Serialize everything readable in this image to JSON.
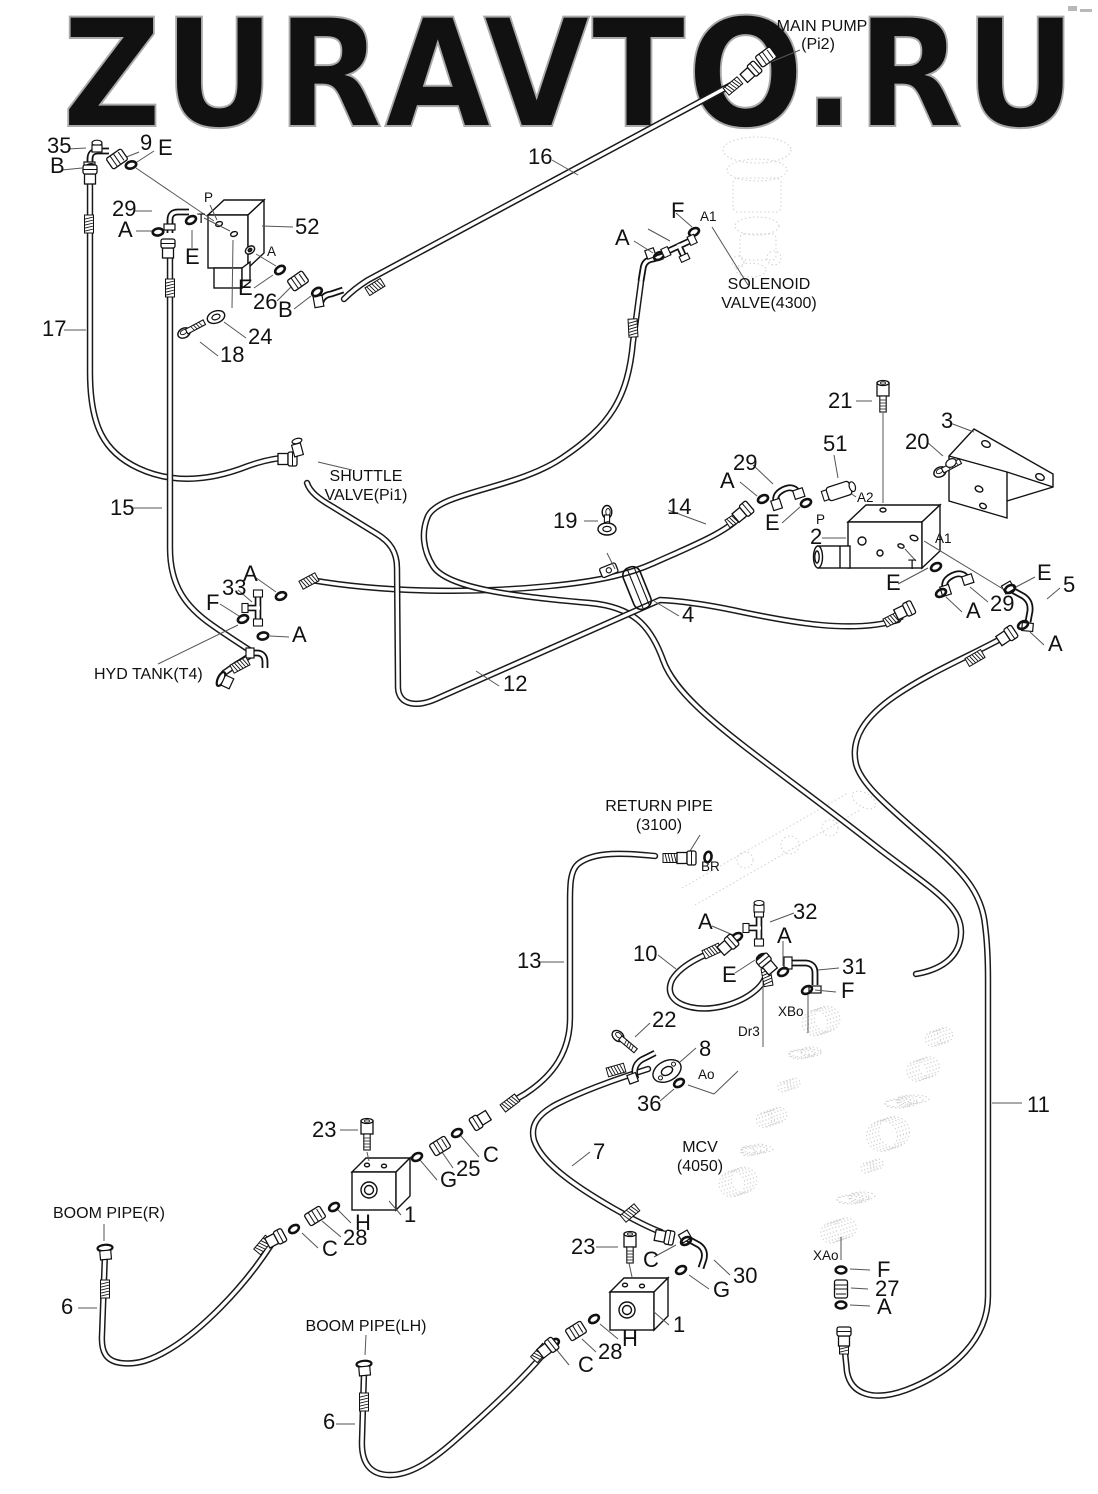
{
  "watermark": {
    "text": "ZURAVTO.RU",
    "color": "#a9a9a9"
  },
  "colors": {
    "line": "#1a1a1a",
    "leader": "#555555",
    "ghost": "#c4c4c4",
    "label": "#111111"
  },
  "labels": {
    "component_names": [
      {
        "t": "MAIN PUMP",
        "x": 822,
        "y": 31,
        "a": "middle"
      },
      {
        "t": "(Pi2)",
        "x": 818,
        "y": 49,
        "a": "middle"
      },
      {
        "t": "SOLENOID",
        "x": 769,
        "y": 289,
        "a": "middle"
      },
      {
        "t": "VALVE(4300)",
        "x": 769,
        "y": 308,
        "a": "middle"
      },
      {
        "t": "SHUTTLE",
        "x": 366,
        "y": 481,
        "a": "middle"
      },
      {
        "t": "VALVE(Pi1)",
        "x": 366,
        "y": 500,
        "a": "middle"
      },
      {
        "t": "HYD TANK(T4)",
        "x": 94,
        "y": 679,
        "a": "start"
      },
      {
        "t": "RETURN PIPE",
        "x": 659,
        "y": 811,
        "a": "middle"
      },
      {
        "t": "(3100)",
        "x": 659,
        "y": 830,
        "a": "middle"
      },
      {
        "t": "MCV",
        "x": 700,
        "y": 1152,
        "a": "middle"
      },
      {
        "t": "(4050)",
        "x": 700,
        "y": 1171,
        "a": "middle"
      },
      {
        "t": "BOOM PIPE(R)",
        "x": 53,
        "y": 1218,
        "a": "start"
      },
      {
        "t": "BOOM PIPE(LH)",
        "x": 366,
        "y": 1331,
        "a": "middle"
      }
    ],
    "part_numbers": [
      {
        "t": "35",
        "x": 47,
        "y": 153
      },
      {
        "t": "9",
        "x": 140,
        "y": 150
      },
      {
        "t": "17",
        "x": 42,
        "y": 336
      },
      {
        "t": "16",
        "x": 528,
        "y": 164
      },
      {
        "t": "52",
        "x": 295,
        "y": 234
      },
      {
        "t": "26",
        "x": 253,
        "y": 309
      },
      {
        "t": "24",
        "x": 248,
        "y": 344
      },
      {
        "t": "18",
        "x": 220,
        "y": 362
      },
      {
        "t": "29",
        "x": 112,
        "y": 216
      },
      {
        "t": "21",
        "x": 828,
        "y": 408
      },
      {
        "t": "3",
        "x": 941,
        "y": 428
      },
      {
        "t": "20",
        "x": 905,
        "y": 449
      },
      {
        "t": "51",
        "x": 823,
        "y": 451
      },
      {
        "t": "2",
        "x": 810,
        "y": 544
      },
      {
        "t": "5",
        "x": 1063,
        "y": 592
      },
      {
        "t": "29",
        "x": 733,
        "y": 470
      },
      {
        "t": "29",
        "x": 990,
        "y": 611
      },
      {
        "t": "15",
        "x": 110,
        "y": 515
      },
      {
        "t": "19",
        "x": 553,
        "y": 528
      },
      {
        "t": "14",
        "x": 667,
        "y": 514
      },
      {
        "t": "33",
        "x": 222,
        "y": 595
      },
      {
        "t": "12",
        "x": 503,
        "y": 691
      },
      {
        "t": "4",
        "x": 682,
        "y": 622
      },
      {
        "t": "32",
        "x": 793,
        "y": 919
      },
      {
        "t": "10",
        "x": 633,
        "y": 961
      },
      {
        "t": "31",
        "x": 842,
        "y": 974
      },
      {
        "t": "22",
        "x": 652,
        "y": 1027
      },
      {
        "t": "8",
        "x": 699,
        "y": 1056
      },
      {
        "t": "36",
        "x": 637,
        "y": 1111
      },
      {
        "t": "13",
        "x": 517,
        "y": 968
      },
      {
        "t": "7",
        "x": 593,
        "y": 1159
      },
      {
        "t": "23",
        "x": 312,
        "y": 1137
      },
      {
        "t": "25",
        "x": 456,
        "y": 1176
      },
      {
        "t": "28",
        "x": 343,
        "y": 1245
      },
      {
        "t": "23",
        "x": 571,
        "y": 1254
      },
      {
        "t": "30",
        "x": 733,
        "y": 1283
      },
      {
        "t": "28",
        "x": 598,
        "y": 1359
      },
      {
        "t": "27",
        "x": 875,
        "y": 1296
      },
      {
        "t": "11",
        "x": 1027,
        "y": 1112
      },
      {
        "t": "6",
        "x": 61,
        "y": 1314
      },
      {
        "t": "6",
        "x": 323,
        "y": 1429
      },
      {
        "t": "1",
        "x": 404,
        "y": 1222
      },
      {
        "t": "1",
        "x": 673,
        "y": 1332
      }
    ],
    "fitting_letters": [
      {
        "t": "E",
        "x": 158,
        "y": 155
      },
      {
        "t": "B",
        "x": 50,
        "y": 173
      },
      {
        "t": "A",
        "x": 118,
        "y": 237
      },
      {
        "t": "E",
        "x": 185,
        "y": 264
      },
      {
        "t": "E",
        "x": 238,
        "y": 295
      },
      {
        "t": "B",
        "x": 278,
        "y": 317
      },
      {
        "t": "F",
        "x": 671,
        "y": 218
      },
      {
        "t": "A",
        "x": 615,
        "y": 245
      },
      {
        "t": "A",
        "x": 720,
        "y": 488
      },
      {
        "t": "E",
        "x": 765,
        "y": 530
      },
      {
        "t": "E",
        "x": 886,
        "y": 590
      },
      {
        "t": "A",
        "x": 966,
        "y": 618
      },
      {
        "t": "E",
        "x": 1037,
        "y": 580
      },
      {
        "t": "A",
        "x": 1048,
        "y": 651
      },
      {
        "t": "A",
        "x": 243,
        "y": 581
      },
      {
        "t": "F",
        "x": 206,
        "y": 610
      },
      {
        "t": "A",
        "x": 292,
        "y": 642
      },
      {
        "t": "A",
        "x": 698,
        "y": 929
      },
      {
        "t": "A",
        "x": 777,
        "y": 943
      },
      {
        "t": "E",
        "x": 722,
        "y": 982
      },
      {
        "t": "F",
        "x": 841,
        "y": 998
      },
      {
        "t": "C",
        "x": 483,
        "y": 1162
      },
      {
        "t": "G",
        "x": 440,
        "y": 1187
      },
      {
        "t": "H",
        "x": 355,
        "y": 1230
      },
      {
        "t": "C",
        "x": 322,
        "y": 1256
      },
      {
        "t": "C",
        "x": 643,
        "y": 1267
      },
      {
        "t": "G",
        "x": 713,
        "y": 1297
      },
      {
        "t": "H",
        "x": 622,
        "y": 1346
      },
      {
        "t": "C",
        "x": 578,
        "y": 1372
      },
      {
        "t": "F",
        "x": 877,
        "y": 1277
      },
      {
        "t": "A",
        "x": 877,
        "y": 1314
      }
    ],
    "port_labels": [
      {
        "t": "P",
        "x": 204,
        "y": 202
      },
      {
        "t": "T",
        "x": 197,
        "y": 223
      },
      {
        "t": "A",
        "x": 267,
        "y": 256
      },
      {
        "t": "A1",
        "x": 700,
        "y": 221
      },
      {
        "t": "A2",
        "x": 857,
        "y": 502
      },
      {
        "t": "P",
        "x": 816,
        "y": 524
      },
      {
        "t": "A1",
        "x": 935,
        "y": 543
      },
      {
        "t": "T",
        "x": 908,
        "y": 569
      },
      {
        "t": "BR",
        "x": 701,
        "y": 871
      },
      {
        "t": "XBo",
        "x": 778,
        "y": 1016
      },
      {
        "t": "Dr3",
        "x": 738,
        "y": 1036
      },
      {
        "t": "Ao",
        "x": 698,
        "y": 1079
      },
      {
        "t": "XAo",
        "x": 813,
        "y": 1260
      }
    ]
  }
}
